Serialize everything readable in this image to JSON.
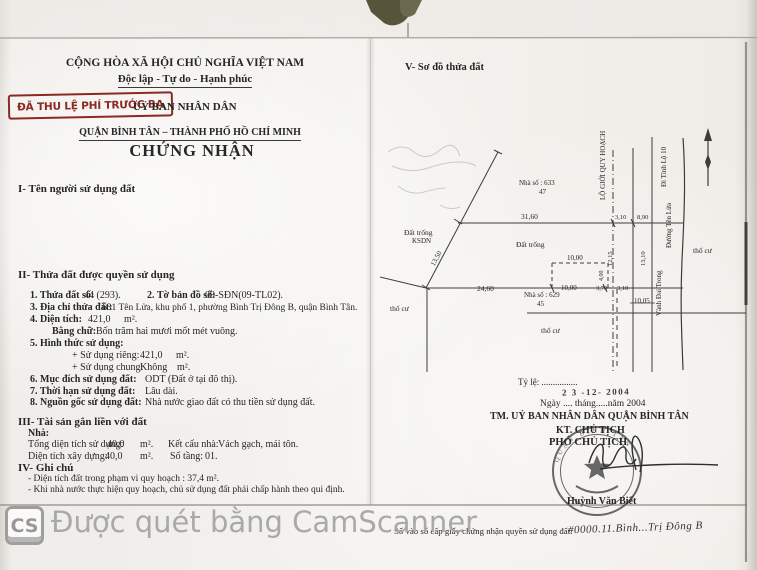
{
  "header": {
    "national_title": "CỘNG HÒA XÃ HỘI CHỦ NGHĨA VIỆT NAM",
    "national_motto": "Độc lập - Tự do - Hạnh phúc",
    "fee_stamp": "ĐÃ THU LỆ PHÍ TRƯỚC BẠ",
    "issuer": "UỶ BAN NHÂN DÂN",
    "district_line": "QUẬN BÌNH TÂN – THÀNH PHỐ HỒ CHÍ MINH",
    "doc_title": "CHỨNG NHẬN"
  },
  "section1": {
    "heading": "I- Tên người sử dụng đất"
  },
  "section2": {
    "heading": "II- Thửa đất được quyền sử dụng",
    "item1_label": "1. Thửa đất số:",
    "item1_value": "44 (293).",
    "item2_label": "2. Tờ bản đồ số:",
    "item2_value": "09-SĐN(09-TL02).",
    "item3_label": "3. Địa chỉ thửa đất:",
    "item3_value": "631 Tên Lửa, khu phố 1, phường Bình Trị Đông B, quận Bình Tân.",
    "item4_label": "4. Diện tích:",
    "item4_value": "421,0",
    "item4_unit": "m².",
    "item4b_label": "Bằng chữ:",
    "item4b_value": "Bốn trăm hai mươi mốt mét vuông.",
    "item5_label": "5. Hình thức sử dụng:",
    "item5a_label": "+ Sử dụng riêng:",
    "item5a_value": "421,0",
    "item5a_unit": "m².",
    "item5b_label": "+ Sử dụng chung:",
    "item5b_value": "Không",
    "item5b_unit": "m².",
    "item6_label": "6. Mục đích sử dụng đất:",
    "item6_value": "ODT (Đất ở tại đô thị).",
    "item7_label": "7. Thời hạn sử dụng đất:",
    "item7_value": "Lâu dài.",
    "item8_label": "8. Nguồn gốc sử dụng đất:",
    "item8_value": "Nhà nước giao đất có thu tiền sử dụng đất."
  },
  "section3": {
    "heading": "III- Tài sản gắn liền với đất",
    "sub": "Nhà:",
    "row1_label": "Tổng diện tích sử dụng:",
    "row1_value": "40,0",
    "row1_unit": "m².",
    "row1_label2": "Kết cấu nhà:",
    "row1_value2": "Vách gạch, mái tôn.",
    "row2_label": "Diện tích xây dựng:",
    "row2_value": "40,0",
    "row2_unit": "m².",
    "row2_label2": "Số tầng:",
    "row2_value2": "01."
  },
  "section4": {
    "heading": "IV- Ghi chú",
    "note1": "- Diện tích đất trong phạm vi quy hoạch : 37,4 m².",
    "note2": "- Khi nhà nước thực hiện quy hoạch, chủ sử dụng đất phải chấp hành theo qui định."
  },
  "map": {
    "heading": "V- Sơ đồ thửa đất",
    "house633": "Nhà số : 633",
    "house633_no": "47",
    "house629": "Nhà số : 629",
    "house629_no": "45",
    "vacant1a": "Đất trống",
    "vacant1b": "KSDN",
    "vacant2": "Đất trống",
    "resid1": "thổ cư",
    "resid2": "thổ cư",
    "resid3": "thổ cư",
    "m3160": "31,60",
    "m310a": "3,10",
    "m890": "8,90",
    "m1350": "13,50",
    "m1000a": "10,00",
    "m2460": "24,60",
    "m1000b": "10,00",
    "m370": "3,70",
    "m310b": "3,10",
    "m1005": "10,05",
    "m1215": "12,15",
    "m1310": "13,10",
    "m400": "4,00",
    "road_boundary": "LỘ GIỚI QUY HOẠCH",
    "road_tinhlo": "Đi Tỉnh Lộ 10",
    "road_tenlua": "Đường Tên Lửa",
    "road_vanhdai": "Vành Đai Trong"
  },
  "signing": {
    "scale": "Tỷ lệ: ................",
    "date_stamp": "2 3 -12- 2004",
    "date_line": "Ngày .... tháng.....năm 2004",
    "authority": "TM. UỶ BAN NHÂN DÂN QUẬN BÌNH TÂN",
    "title_kt": "KT. CHỦ TỊCH",
    "title_pho": "PHÓ CHỦ TỊCH",
    "stamp_arc": "QUẬN BÌNH TÂN",
    "signer": "Huỳnh Văn Biết"
  },
  "footer": {
    "registry_label": "Số vào sổ cấp giấy chứng nhận quyền sử dụng đất:",
    "registry_value": "#0000.11.Bình...Trị Đông B"
  },
  "watermark": {
    "logo": "CS",
    "text": "Được quét bằng CamScanner"
  },
  "colors": {
    "fee_stamp_red": "#8a2a22",
    "ink": "#2b2b2b",
    "watermark_gray": "#a9a9a9"
  }
}
